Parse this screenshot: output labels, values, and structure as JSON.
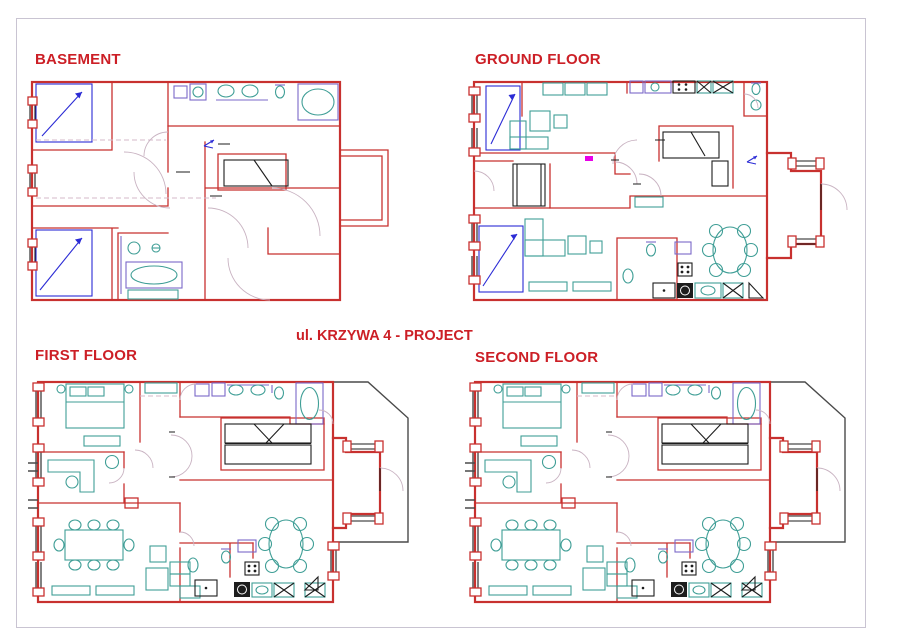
{
  "title": {
    "text": "ul. KRZYWA 4 - PROJECT"
  },
  "plans": {
    "basement": {
      "label": "BASEMENT"
    },
    "ground": {
      "label": "GROUND FLOOR"
    },
    "first": {
      "label": "FIRST FLOOR"
    },
    "second": {
      "label": "SECOND FLOOR"
    }
  },
  "colors": {
    "wall_red": "#c8312f",
    "label_red": "#cc1f26",
    "furniture_teal": "#3f9e96",
    "stair_blue": "#2b2bd5",
    "fixture_violet": "#7b68c8",
    "hatch_magenta": "#cf4fcf",
    "accent_magenta": "#e800e8",
    "detail_black": "#1d1d1d",
    "frame_grey": "#c9c4d2",
    "arc_grey": "#c9b3c2"
  }
}
